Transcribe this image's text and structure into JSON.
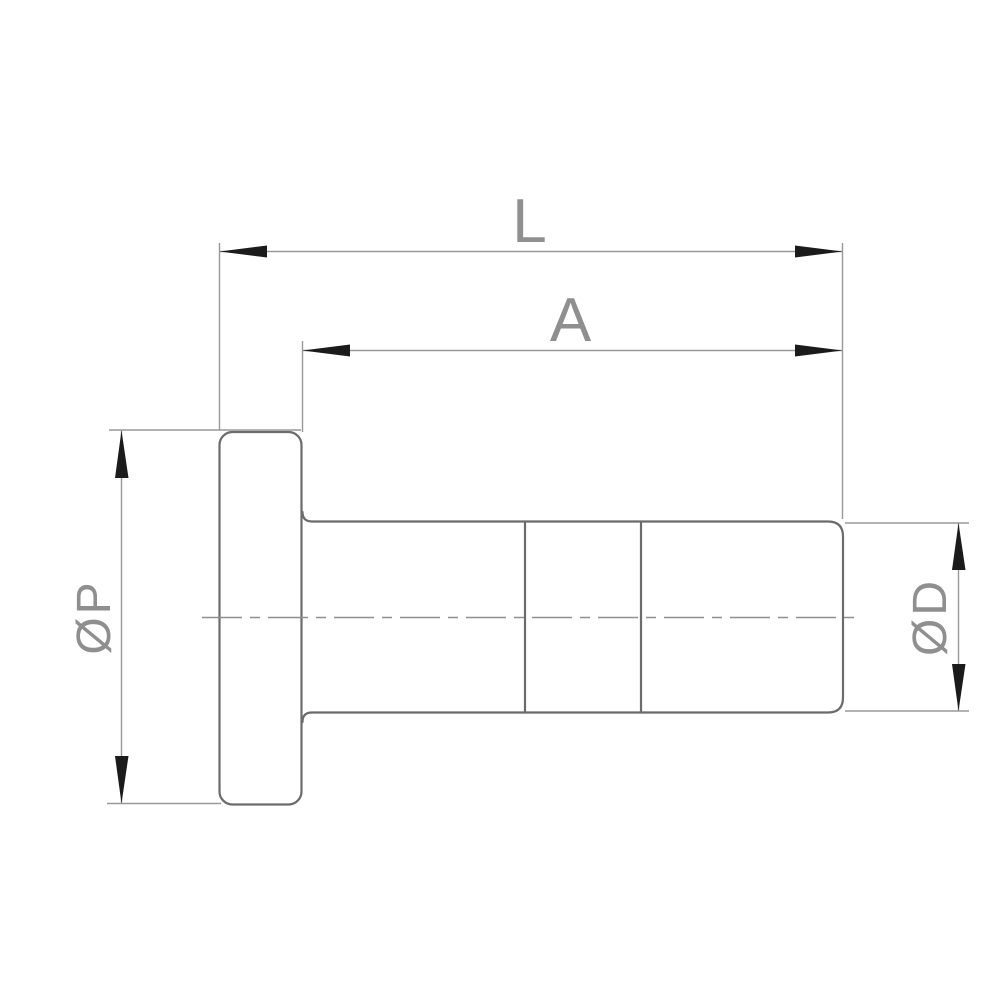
{
  "drawing": {
    "type": "technical-drawing",
    "view": "side-view-flanged-tube-fitting",
    "labels": {
      "overall_length": "L",
      "body_length": "A",
      "flange_diameter": "ØP",
      "tube_diameter": "ØD"
    },
    "colors": {
      "background": "#ffffff",
      "part_outline": "#6b6b6b",
      "dimension_lines": "#999999",
      "arrowheads": "#1b1b1b",
      "label_text": "#8f8f8f"
    }
  }
}
